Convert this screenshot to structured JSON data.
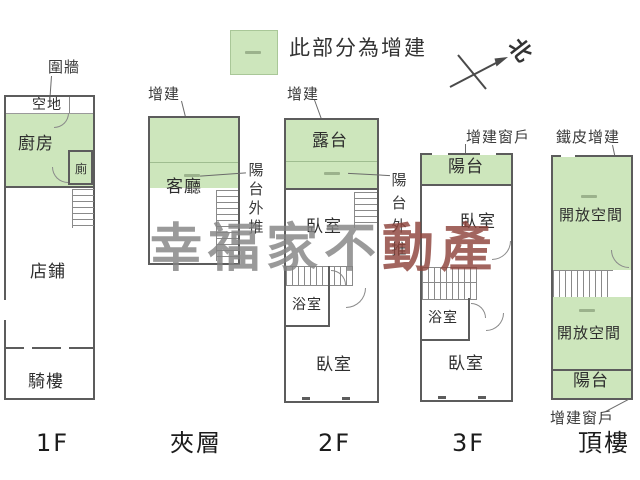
{
  "legend": {
    "note": "此部分為增建"
  },
  "compass": {
    "north": "北"
  },
  "watermark": {
    "part1": "幸福家不",
    "part2": "動產"
  },
  "floor1": {
    "name": "1F",
    "fence": "圍牆",
    "vacant": "空地",
    "kitchen": "廚房",
    "toilet": "廁",
    "shop": "店鋪",
    "arcade": "騎樓"
  },
  "mezzanine": {
    "name": "夾層",
    "addition": "增建",
    "living_room": "客廳",
    "balcony_pushout": "陽台外推"
  },
  "floor2": {
    "name": "2F",
    "addition": "增建",
    "terrace": "露台",
    "bedroom_upper": "臥室",
    "bathroom": "浴室",
    "bedroom_lower": "臥室",
    "balcony_pushout": "陽台外推"
  },
  "floor3": {
    "name": "3F",
    "added_window": "增建窗戶",
    "balcony": "陽台",
    "bedroom_upper": "臥室",
    "bathroom": "浴室",
    "bedroom_lower": "臥室"
  },
  "roof": {
    "name": "頂樓",
    "metal_addition": "鐵皮增建",
    "open_space_upper": "開放空間",
    "open_space_lower": "開放空間",
    "balcony": "陽台",
    "added_window": "增建窗戶"
  },
  "colors": {
    "addition_green": "#cde6bc",
    "wall": "#5c5c5c",
    "watermark_gray": "#848484",
    "watermark_red": "#8e443c"
  }
}
